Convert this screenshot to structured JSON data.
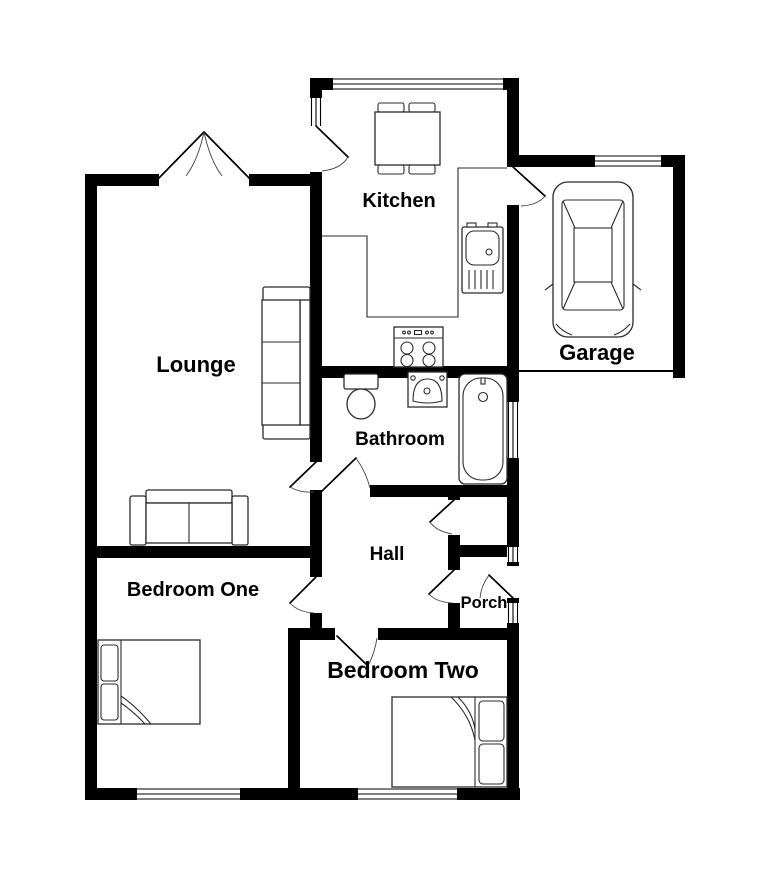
{
  "diagram_type": "floor-plan",
  "colors": {
    "wall": "#000000",
    "background": "#ffffff",
    "furniture_line": "#2b2b2b"
  },
  "rooms": [
    {
      "id": "kitchen",
      "label": "Kitchen"
    },
    {
      "id": "garage",
      "label": "Garage"
    },
    {
      "id": "lounge",
      "label": "Lounge"
    },
    {
      "id": "bathroom",
      "label": "Bathroom"
    },
    {
      "id": "hall",
      "label": "Hall"
    },
    {
      "id": "porch",
      "label": "Porch"
    },
    {
      "id": "bedroom-one",
      "label": "Bedroom One"
    },
    {
      "id": "bedroom-two",
      "label": "Bedroom Two"
    }
  ],
  "furniture": [
    {
      "icon": "dining-table-icon",
      "room": "Kitchen"
    },
    {
      "icon": "kitchen-counter-icon",
      "room": "Kitchen"
    },
    {
      "icon": "kitchen-sink-icon",
      "room": "Kitchen"
    },
    {
      "icon": "hob-icon",
      "room": "Kitchen"
    },
    {
      "icon": "car-icon",
      "room": "Garage"
    },
    {
      "icon": "sofa-three-seat-icon",
      "room": "Lounge"
    },
    {
      "icon": "sofa-two-seat-icon",
      "room": "Lounge"
    },
    {
      "icon": "toilet-icon",
      "room": "Bathroom"
    },
    {
      "icon": "wash-basin-icon",
      "room": "Bathroom"
    },
    {
      "icon": "bathtub-icon",
      "room": "Bathroom"
    },
    {
      "icon": "single-bed-icon",
      "room": "Bedroom One"
    },
    {
      "icon": "double-bed-icon",
      "room": "Bedroom Two"
    }
  ]
}
